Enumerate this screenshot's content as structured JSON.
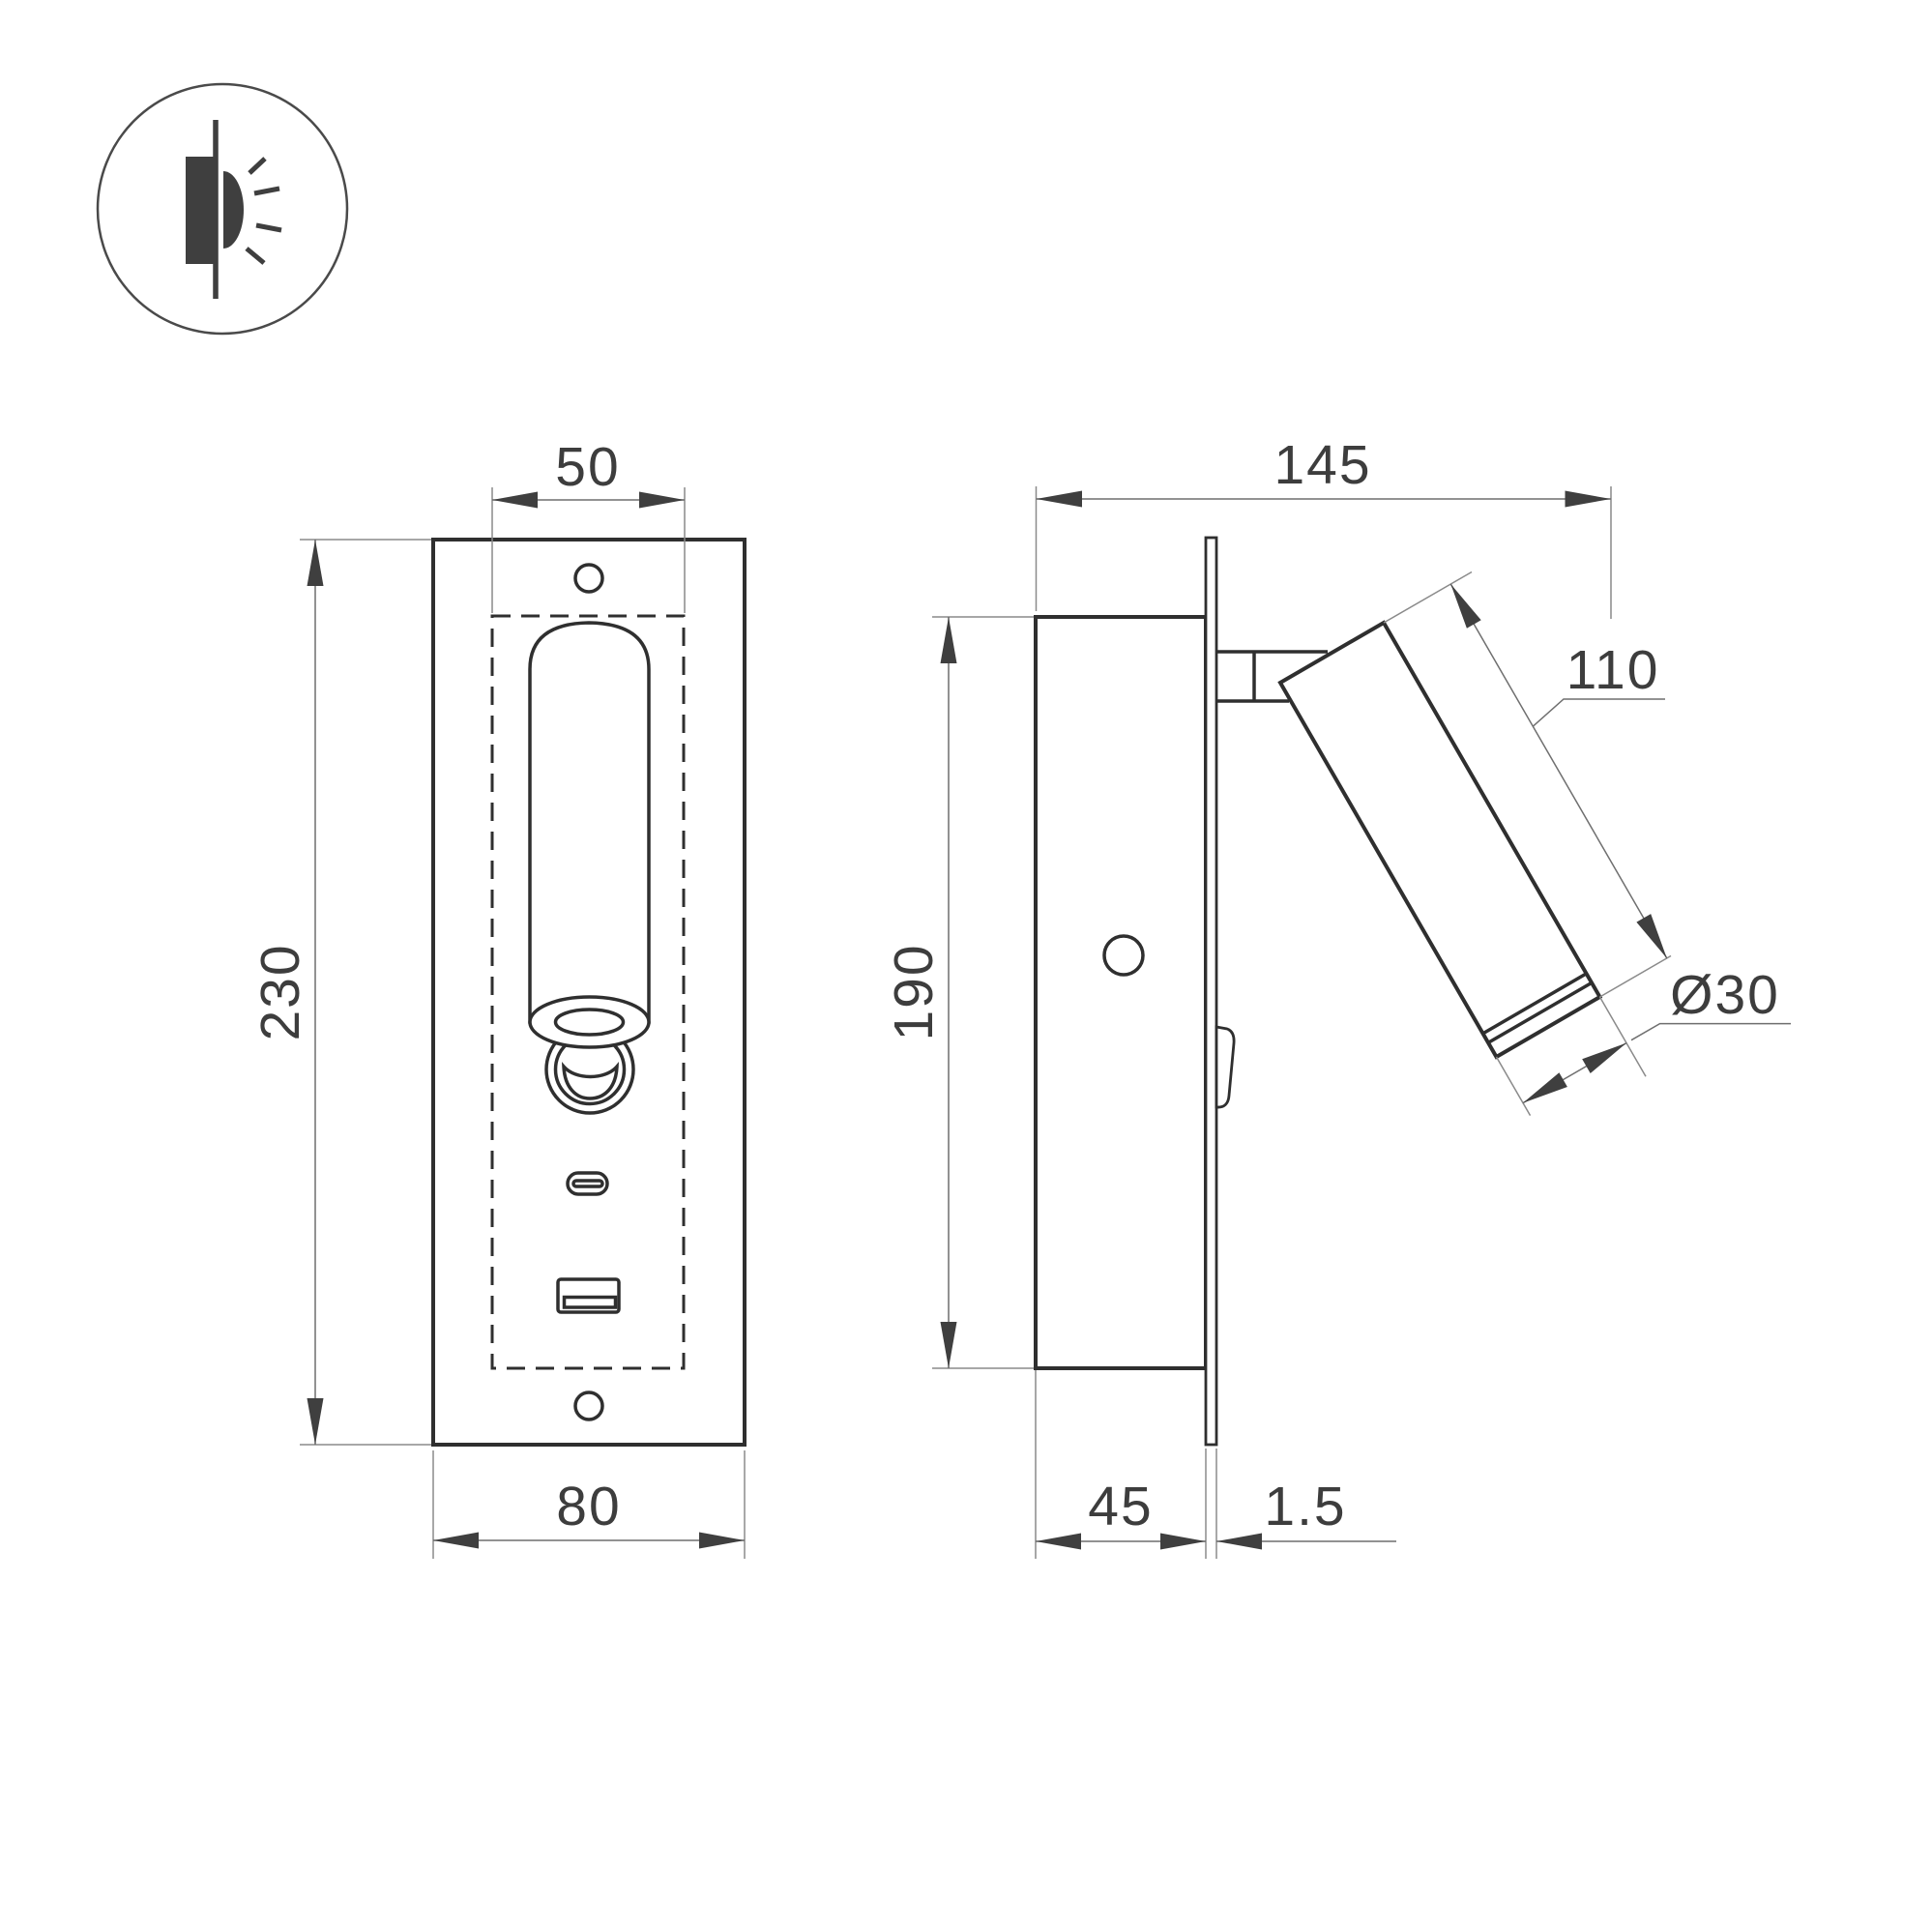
{
  "drawing": {
    "type": "technical-dimension-drawing",
    "subject": "recessed wall reading light with USB charging ports",
    "background_color": "#ffffff",
    "object_line_color": "#2f2f2f",
    "dimension_line_color": "#6f6f6f",
    "text_color": "#3d3d3d"
  },
  "icon": {
    "name": "recessed-wall-light-icon"
  },
  "front_view": {
    "name": "front-view",
    "dims": {
      "cutout_width": "50",
      "panel_height": "230",
      "panel_width": "80"
    }
  },
  "side_view": {
    "name": "side-view",
    "dims": {
      "total_depth": "145",
      "recess_height": "190",
      "lamp_length": "110",
      "lamp_diameter": "Ø30",
      "recess_depth": "45",
      "faceplate_thickness": "1.5"
    }
  }
}
